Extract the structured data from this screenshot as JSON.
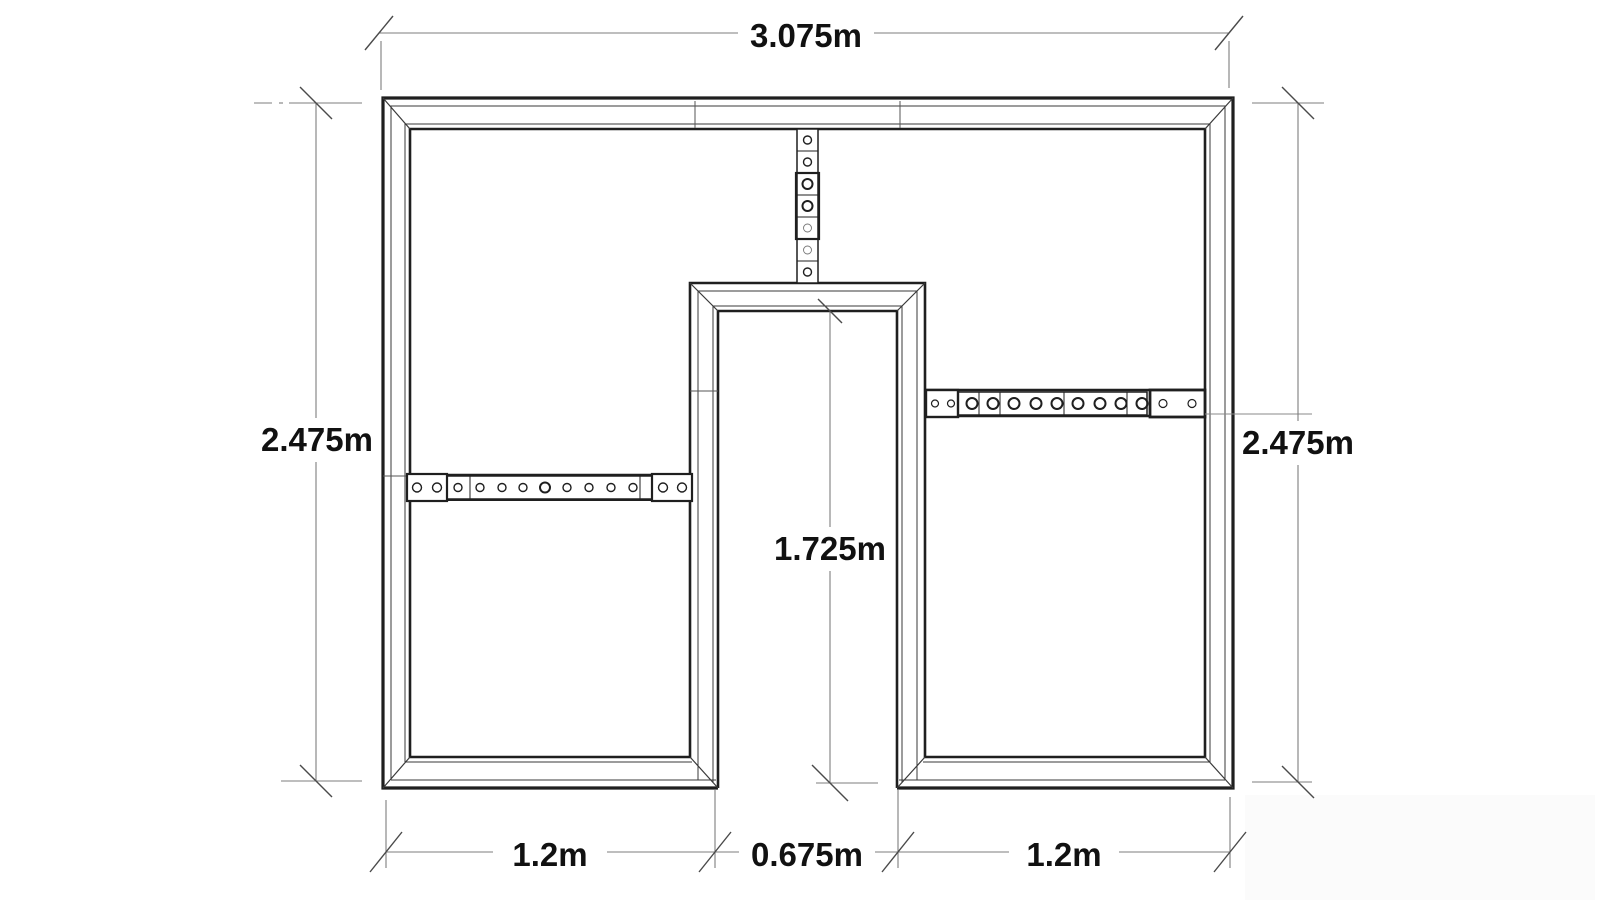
{
  "document": {
    "type": "architectural dimension drawing of a wall frame with central doorway opening",
    "background": "#ffffff",
    "wall_line_color": "#1f1f1f",
    "dim_line_color": "#7d7d7d"
  },
  "dimensions": {
    "top_width": "3.075m",
    "left_height": "2.475m",
    "right_height": "2.475m",
    "opening_height": "1.725m",
    "bottom_left": "1.2m",
    "bottom_center": "0.675m",
    "bottom_right": "1.2m"
  }
}
